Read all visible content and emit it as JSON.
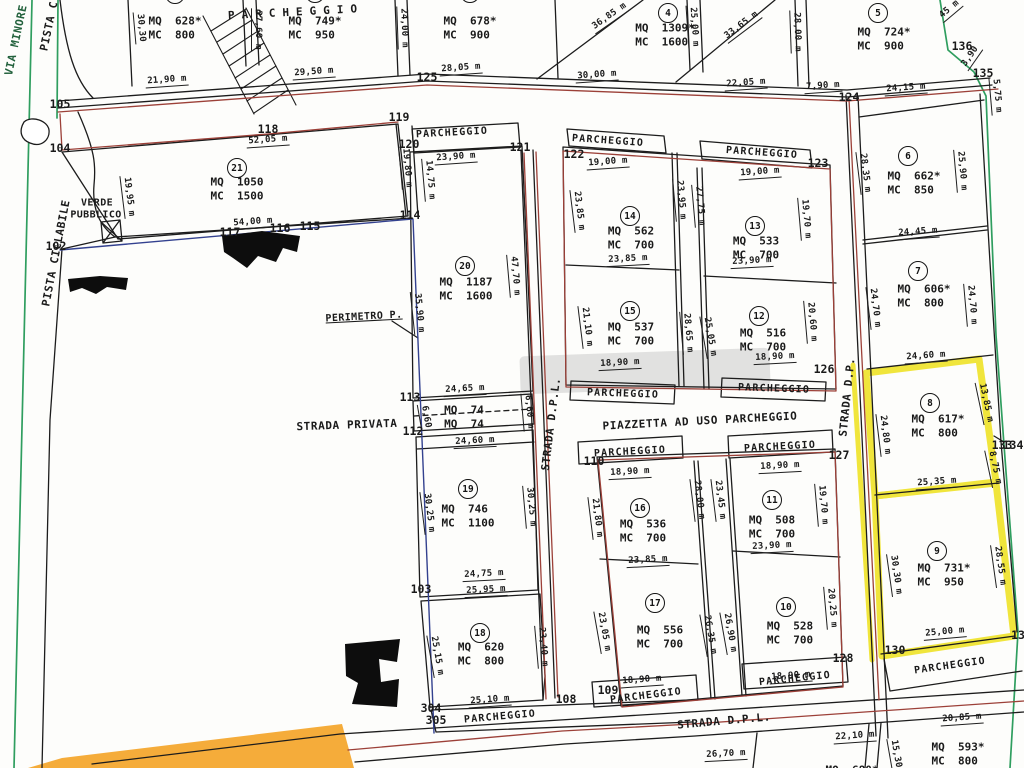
{
  "plan": {
    "parking_text": "PARCHEGGIO",
    "highlighted_lots": [
      "8",
      "9"
    ],
    "colors": {
      "boundary_red": "#9c4038",
      "boundary_blue": "#33418f",
      "boundary_green": "#2f9e5f",
      "highlight_yellow": "#efe32b",
      "highlight_orange": "#f5ac3a",
      "ink": "#1c1c1c"
    },
    "streets": [
      {
        "t": "VIA MINORE",
        "x": 16,
        "y": 40,
        "r": -78,
        "green": true
      },
      {
        "t": "PISTA C",
        "x": 49,
        "y": 26,
        "r": -78
      },
      {
        "t": "PISTA CICLABILE",
        "x": 56,
        "y": 253,
        "r": -79
      },
      {
        "t": "STRADA PRIVATA",
        "x": 347,
        "y": 425,
        "r": -2
      },
      {
        "t": "STRADA D.P.L.",
        "x": 551,
        "y": 424,
        "r": -83
      },
      {
        "t": "PIAZZETTA AD USO PARCHEGGIO",
        "x": 700,
        "y": 421,
        "r": -3
      },
      {
        "t": "STRADA D.P.",
        "x": 847,
        "y": 397,
        "r": -84
      },
      {
        "t": "STRADA D.P.L.",
        "x": 724,
        "y": 721,
        "r": -5
      }
    ],
    "area_labels": [
      {
        "t": "VERDE",
        "x": 97,
        "y": 203,
        "r": 0
      },
      {
        "t": "PUBBLICO",
        "x": 96,
        "y": 215,
        "r": 0
      },
      {
        "t": "PERIMETRO P.",
        "x": 364,
        "y": 317,
        "r": -3,
        "u": true
      }
    ],
    "parking_labels": [
      {
        "x": 296,
        "y": 12,
        "r": -3,
        "wide": true
      },
      {
        "x": 452,
        "y": 133,
        "r": -3
      },
      {
        "x": 608,
        "y": 141,
        "r": 4
      },
      {
        "x": 762,
        "y": 153,
        "r": 4
      },
      {
        "x": 623,
        "y": 394,
        "r": 2
      },
      {
        "x": 774,
        "y": 389,
        "r": 2
      },
      {
        "x": 630,
        "y": 452,
        "r": -3
      },
      {
        "x": 780,
        "y": 447,
        "r": -3
      },
      {
        "x": 500,
        "y": 717,
        "r": -5
      },
      {
        "x": 646,
        "y": 696,
        "r": -7
      },
      {
        "x": 795,
        "y": 679,
        "r": -6
      },
      {
        "x": 950,
        "y": 666,
        "r": -8
      }
    ],
    "point_markers": [
      {
        "t": "105",
        "x": 60,
        "y": 104
      },
      {
        "t": "104",
        "x": 60,
        "y": 148
      },
      {
        "t": "102",
        "x": 56,
        "y": 246
      },
      {
        "t": "118",
        "x": 268,
        "y": 129
      },
      {
        "t": "119",
        "x": 399,
        "y": 117
      },
      {
        "t": "120",
        "x": 409,
        "y": 144
      },
      {
        "t": "121",
        "x": 520,
        "y": 147
      },
      {
        "t": "122",
        "x": 574,
        "y": 154
      },
      {
        "t": "123",
        "x": 818,
        "y": 163
      },
      {
        "t": "124",
        "x": 849,
        "y": 97
      },
      {
        "t": "125",
        "x": 427,
        "y": 77
      },
      {
        "t": "126",
        "x": 824,
        "y": 369
      },
      {
        "t": "127",
        "x": 839,
        "y": 455
      },
      {
        "t": "128",
        "x": 843,
        "y": 658
      },
      {
        "t": "110",
        "x": 594,
        "y": 461
      },
      {
        "t": "113",
        "x": 410,
        "y": 397
      },
      {
        "t": "112",
        "x": 413,
        "y": 431
      },
      {
        "t": "103",
        "x": 421,
        "y": 589
      },
      {
        "t": "108",
        "x": 566,
        "y": 699
      },
      {
        "t": "109",
        "x": 608,
        "y": 690
      },
      {
        "t": "304",
        "x": 431,
        "y": 708
      },
      {
        "t": "305",
        "x": 436,
        "y": 720
      },
      {
        "t": "130",
        "x": 895,
        "y": 650
      },
      {
        "t": "13",
        "x": 1018,
        "y": 635
      },
      {
        "t": "133",
        "x": 1002,
        "y": 445
      },
      {
        "t": "134",
        "x": 1013,
        "y": 445
      },
      {
        "t": "135",
        "x": 983,
        "y": 73
      },
      {
        "t": "136",
        "x": 962,
        "y": 46
      },
      {
        "t": "117",
        "x": 230,
        "y": 232
      },
      {
        "t": "116",
        "x": 280,
        "y": 228
      },
      {
        "t": "115",
        "x": 310,
        "y": 226
      },
      {
        "t": "114",
        "x": 410,
        "y": 215
      }
    ],
    "dimensions": [
      {
        "t": "21,90 m",
        "x": 167,
        "y": 81,
        "r": -4
      },
      {
        "t": "27,60 m",
        "x": 257,
        "y": 30,
        "r": 90
      },
      {
        "t": "30,30",
        "x": 140,
        "y": 28,
        "r": 85
      },
      {
        "t": "29,50 m",
        "x": 314,
        "y": 73,
        "r": -4
      },
      {
        "t": "24,00 m",
        "x": 403,
        "y": 28,
        "r": 88
      },
      {
        "t": "28,05 m",
        "x": 461,
        "y": 69,
        "r": -4
      },
      {
        "t": "30,00 m",
        "x": 597,
        "y": 76,
        "r": -4
      },
      {
        "t": "36,85 m",
        "x": 610,
        "y": 17,
        "r": -35
      },
      {
        "t": "25,00 m",
        "x": 693,
        "y": 27,
        "r": 86
      },
      {
        "t": "33,65 m",
        "x": 742,
        "y": 26,
        "r": -37
      },
      {
        "t": "28,00 m",
        "x": 796,
        "y": 32,
        "r": 88
      },
      {
        "t": "22,05 m",
        "x": 746,
        "y": 84,
        "r": -4
      },
      {
        "t": "7,90 m",
        "x": 823,
        "y": 87,
        "r": -4
      },
      {
        "t": "24,15 m",
        "x": 906,
        "y": 89,
        "r": -4
      },
      {
        "t": "45 m",
        "x": 950,
        "y": 10,
        "r": -40
      },
      {
        "t": "3,90",
        "x": 971,
        "y": 57,
        "r": -55
      },
      {
        "t": "5,75 m",
        "x": 996,
        "y": 96,
        "r": 85
      },
      {
        "t": "52,05 m",
        "x": 268,
        "y": 141,
        "r": -4
      },
      {
        "t": "19,95 m",
        "x": 128,
        "y": 197,
        "r": 83
      },
      {
        "t": "19,80 m",
        "x": 406,
        "y": 168,
        "r": 85
      },
      {
        "t": "14,75 m",
        "x": 429,
        "y": 180,
        "r": 85
      },
      {
        "t": "54,00 m",
        "x": 253,
        "y": 223,
        "r": -4
      },
      {
        "t": "23,90 m",
        "x": 456,
        "y": 158,
        "r": -4
      },
      {
        "t": "47,70 m",
        "x": 514,
        "y": 276,
        "r": 85
      },
      {
        "t": "35,90 m",
        "x": 418,
        "y": 313,
        "r": 84
      },
      {
        "t": "24,65 m",
        "x": 465,
        "y": 390,
        "r": -3
      },
      {
        "t": "6,60",
        "x": 425,
        "y": 417,
        "r": 80
      },
      {
        "t": "6,60 m",
        "x": 528,
        "y": 412,
        "r": 85
      },
      {
        "t": "24,60 m",
        "x": 475,
        "y": 442,
        "r": -3
      },
      {
        "t": "30,25 m",
        "x": 428,
        "y": 513,
        "r": 83
      },
      {
        "t": "30,25 m",
        "x": 530,
        "y": 507,
        "r": 85
      },
      {
        "t": "24,75 m",
        "x": 484,
        "y": 575,
        "r": -3
      },
      {
        "t": "25,95 m",
        "x": 486,
        "y": 591,
        "r": -3
      },
      {
        "t": "25,15 m",
        "x": 436,
        "y": 656,
        "r": 80
      },
      {
        "t": "23,40 m",
        "x": 542,
        "y": 647,
        "r": 85
      },
      {
        "t": "25,10 m",
        "x": 490,
        "y": 701,
        "r": -4
      },
      {
        "t": "19,00 m",
        "x": 608,
        "y": 163,
        "r": -4
      },
      {
        "t": "23,85 m",
        "x": 578,
        "y": 211,
        "r": 83
      },
      {
        "t": "23,95 m",
        "x": 680,
        "y": 200,
        "r": 85
      },
      {
        "t": "27,75 m",
        "x": 699,
        "y": 206,
        "r": 85
      },
      {
        "t": "23,85 m",
        "x": 628,
        "y": 260,
        "r": -3
      },
      {
        "t": "21,10 m",
        "x": 586,
        "y": 327,
        "r": 83
      },
      {
        "t": "28,65 m",
        "x": 687,
        "y": 333,
        "r": 85
      },
      {
        "t": "18,90 m",
        "x": 620,
        "y": 364,
        "r": -3
      },
      {
        "t": "19,00 m",
        "x": 760,
        "y": 173,
        "r": -4
      },
      {
        "t": "19,70 m",
        "x": 805,
        "y": 219,
        "r": 85
      },
      {
        "t": "23,90 m",
        "x": 752,
        "y": 262,
        "r": -3
      },
      {
        "t": "25,05 m",
        "x": 709,
        "y": 337,
        "r": 80
      },
      {
        "t": "20,60 m",
        "x": 811,
        "y": 322,
        "r": 85
      },
      {
        "t": "18,90 m",
        "x": 775,
        "y": 358,
        "r": -3
      },
      {
        "t": "28,35 m",
        "x": 864,
        "y": 173,
        "r": 83
      },
      {
        "t": "25,90 m",
        "x": 961,
        "y": 171,
        "r": 85
      },
      {
        "t": "24,45 m",
        "x": 918,
        "y": 233,
        "r": -4
      },
      {
        "t": "24,70 m",
        "x": 874,
        "y": 308,
        "r": 83
      },
      {
        "t": "24,70 m",
        "x": 971,
        "y": 305,
        "r": 85
      },
      {
        "t": "24,60 m",
        "x": 926,
        "y": 357,
        "r": -4
      },
      {
        "t": "24,80 m",
        "x": 884,
        "y": 435,
        "r": 83
      },
      {
        "t": "13,85 m",
        "x": 985,
        "y": 403,
        "r": 78
      },
      {
        "t": "8,75 m",
        "x": 994,
        "y": 468,
        "r": 78
      },
      {
        "t": "25,35 m",
        "x": 937,
        "y": 483,
        "r": -4
      },
      {
        "t": "30,30 m",
        "x": 895,
        "y": 575,
        "r": 82
      },
      {
        "t": "28,55 m",
        "x": 999,
        "y": 566,
        "r": 82
      },
      {
        "t": "25,00 m",
        "x": 945,
        "y": 633,
        "r": -5
      },
      {
        "t": "18,90 m",
        "x": 630,
        "y": 473,
        "r": -3
      },
      {
        "t": "21,80 m",
        "x": 596,
        "y": 518,
        "r": 83
      },
      {
        "t": "23,85 m",
        "x": 648,
        "y": 561,
        "r": -3
      },
      {
        "t": "23,05 m",
        "x": 603,
        "y": 632,
        "r": 80
      },
      {
        "t": "18,90 m",
        "x": 642,
        "y": 681,
        "r": -4
      },
      {
        "t": "18,90 m",
        "x": 780,
        "y": 467,
        "r": -3
      },
      {
        "t": "28,00 m",
        "x": 698,
        "y": 500,
        "r": 83
      },
      {
        "t": "23,45 m",
        "x": 719,
        "y": 500,
        "r": 83
      },
      {
        "t": "19,70 m",
        "x": 822,
        "y": 505,
        "r": 85
      },
      {
        "t": "23,90 m",
        "x": 772,
        "y": 547,
        "r": -3
      },
      {
        "t": "26,35 m",
        "x": 709,
        "y": 635,
        "r": 80
      },
      {
        "t": "26,90 m",
        "x": 729,
        "y": 633,
        "r": 80
      },
      {
        "t": "20,25 m",
        "x": 831,
        "y": 608,
        "r": 85
      },
      {
        "t": "18,90 m",
        "x": 791,
        "y": 677,
        "r": -4
      },
      {
        "t": "26,70 m",
        "x": 726,
        "y": 755,
        "r": -3
      },
      {
        "t": "22,10 m",
        "x": 855,
        "y": 737,
        "r": -4
      },
      {
        "t": "15,30",
        "x": 895,
        "y": 754,
        "r": 80
      },
      {
        "t": "20,85 m",
        "x": 962,
        "y": 719,
        "r": -4
      }
    ],
    "parcels": [
      {
        "n": "",
        "mq": "MQ  628*",
        "mc": "MC  800",
        "tx": 175,
        "ty": 28,
        "cx": 175,
        "cy": -6
      },
      {
        "n": "",
        "mq": "MQ  749*",
        "mc": "MC  950",
        "tx": 315,
        "ty": 28,
        "cx": 315,
        "cy": -7
      },
      {
        "n": "",
        "mq": "MQ  678*",
        "mc": "MC  900",
        "tx": 470,
        "ty": 28,
        "cx": 470,
        "cy": -7
      },
      {
        "n": "4",
        "mq": "MQ  1309*",
        "mc": "MC  1600",
        "tx": 665,
        "ty": 35,
        "cx": 668,
        "cy": 13
      },
      {
        "n": "5",
        "mq": "MQ  724*",
        "mc": "MC  900",
        "tx": 884,
        "ty": 39,
        "cx": 878,
        "cy": 13
      },
      {
        "n": "6",
        "mq": "MQ  662*",
        "mc": "MC  850",
        "tx": 914,
        "ty": 183,
        "cx": 908,
        "cy": 156
      },
      {
        "n": "7",
        "mq": "MQ  606*",
        "mc": "MC  800",
        "tx": 924,
        "ty": 296,
        "cx": 918,
        "cy": 271
      },
      {
        "n": "8",
        "mq": "MQ  617*",
        "mc": "MC  800",
        "tx": 938,
        "ty": 426,
        "cx": 930,
        "cy": 403
      },
      {
        "n": "9",
        "mq": "MQ  731*",
        "mc": "MC  950",
        "tx": 944,
        "ty": 575,
        "cx": 937,
        "cy": 551
      },
      {
        "n": "10",
        "mq": "MQ  528",
        "mc": "MC  700",
        "tx": 790,
        "ty": 633,
        "cx": 786,
        "cy": 607
      },
      {
        "n": "11",
        "mq": "MQ  508",
        "mc": "MC  700",
        "tx": 772,
        "ty": 527,
        "cx": 772,
        "cy": 500
      },
      {
        "n": "12",
        "mq": "MQ  516",
        "mc": "MC  700",
        "tx": 763,
        "ty": 340,
        "cx": 759,
        "cy": 316
      },
      {
        "n": "13",
        "mq": "MQ  533",
        "mc": "MC  700",
        "tx": 756,
        "ty": 248,
        "cx": 755,
        "cy": 226
      },
      {
        "n": "14",
        "mq": "MQ  562",
        "mc": "MC  700",
        "tx": 631,
        "ty": 238,
        "cx": 630,
        "cy": 216
      },
      {
        "n": "15",
        "mq": "MQ  537",
        "mc": "MC  700",
        "tx": 631,
        "ty": 334,
        "cx": 630,
        "cy": 311
      },
      {
        "n": "16",
        "mq": "MQ  536",
        "mc": "MC  700",
        "tx": 643,
        "ty": 531,
        "cx": 640,
        "cy": 508
      },
      {
        "n": "17",
        "mq": "MQ  556",
        "mc": "MC  700",
        "tx": 660,
        "ty": 637,
        "cx": 655,
        "cy": 603
      },
      {
        "n": "18",
        "mq": "MQ  620",
        "mc": "MC  800",
        "tx": 481,
        "ty": 654,
        "cx": 480,
        "cy": 633
      },
      {
        "n": "19",
        "mq": "MQ  746",
        "mc": "MC  1100",
        "tx": 468,
        "ty": 516,
        "cx": 468,
        "cy": 489
      },
      {
        "n": "20",
        "mq": "MQ  1187",
        "mc": "MC  1600",
        "tx": 466,
        "ty": 289,
        "cx": 465,
        "cy": 266
      },
      {
        "n": "21",
        "mq": "MQ  1050",
        "mc": "MC  1500",
        "tx": 237,
        "ty": 189,
        "cx": 237,
        "cy": 168
      },
      {
        "n": "",
        "mq": "MQ  593*",
        "mc": "MC  800",
        "tx": 958,
        "ty": 754
      },
      {
        "n": "",
        "mq": "MQ  680*",
        "mc": "",
        "tx": 852,
        "ty": 770
      },
      {
        "n": "",
        "mq": "MQ  74",
        "mc": "MQ  74",
        "tx": 464,
        "ty": 417
      }
    ]
  }
}
